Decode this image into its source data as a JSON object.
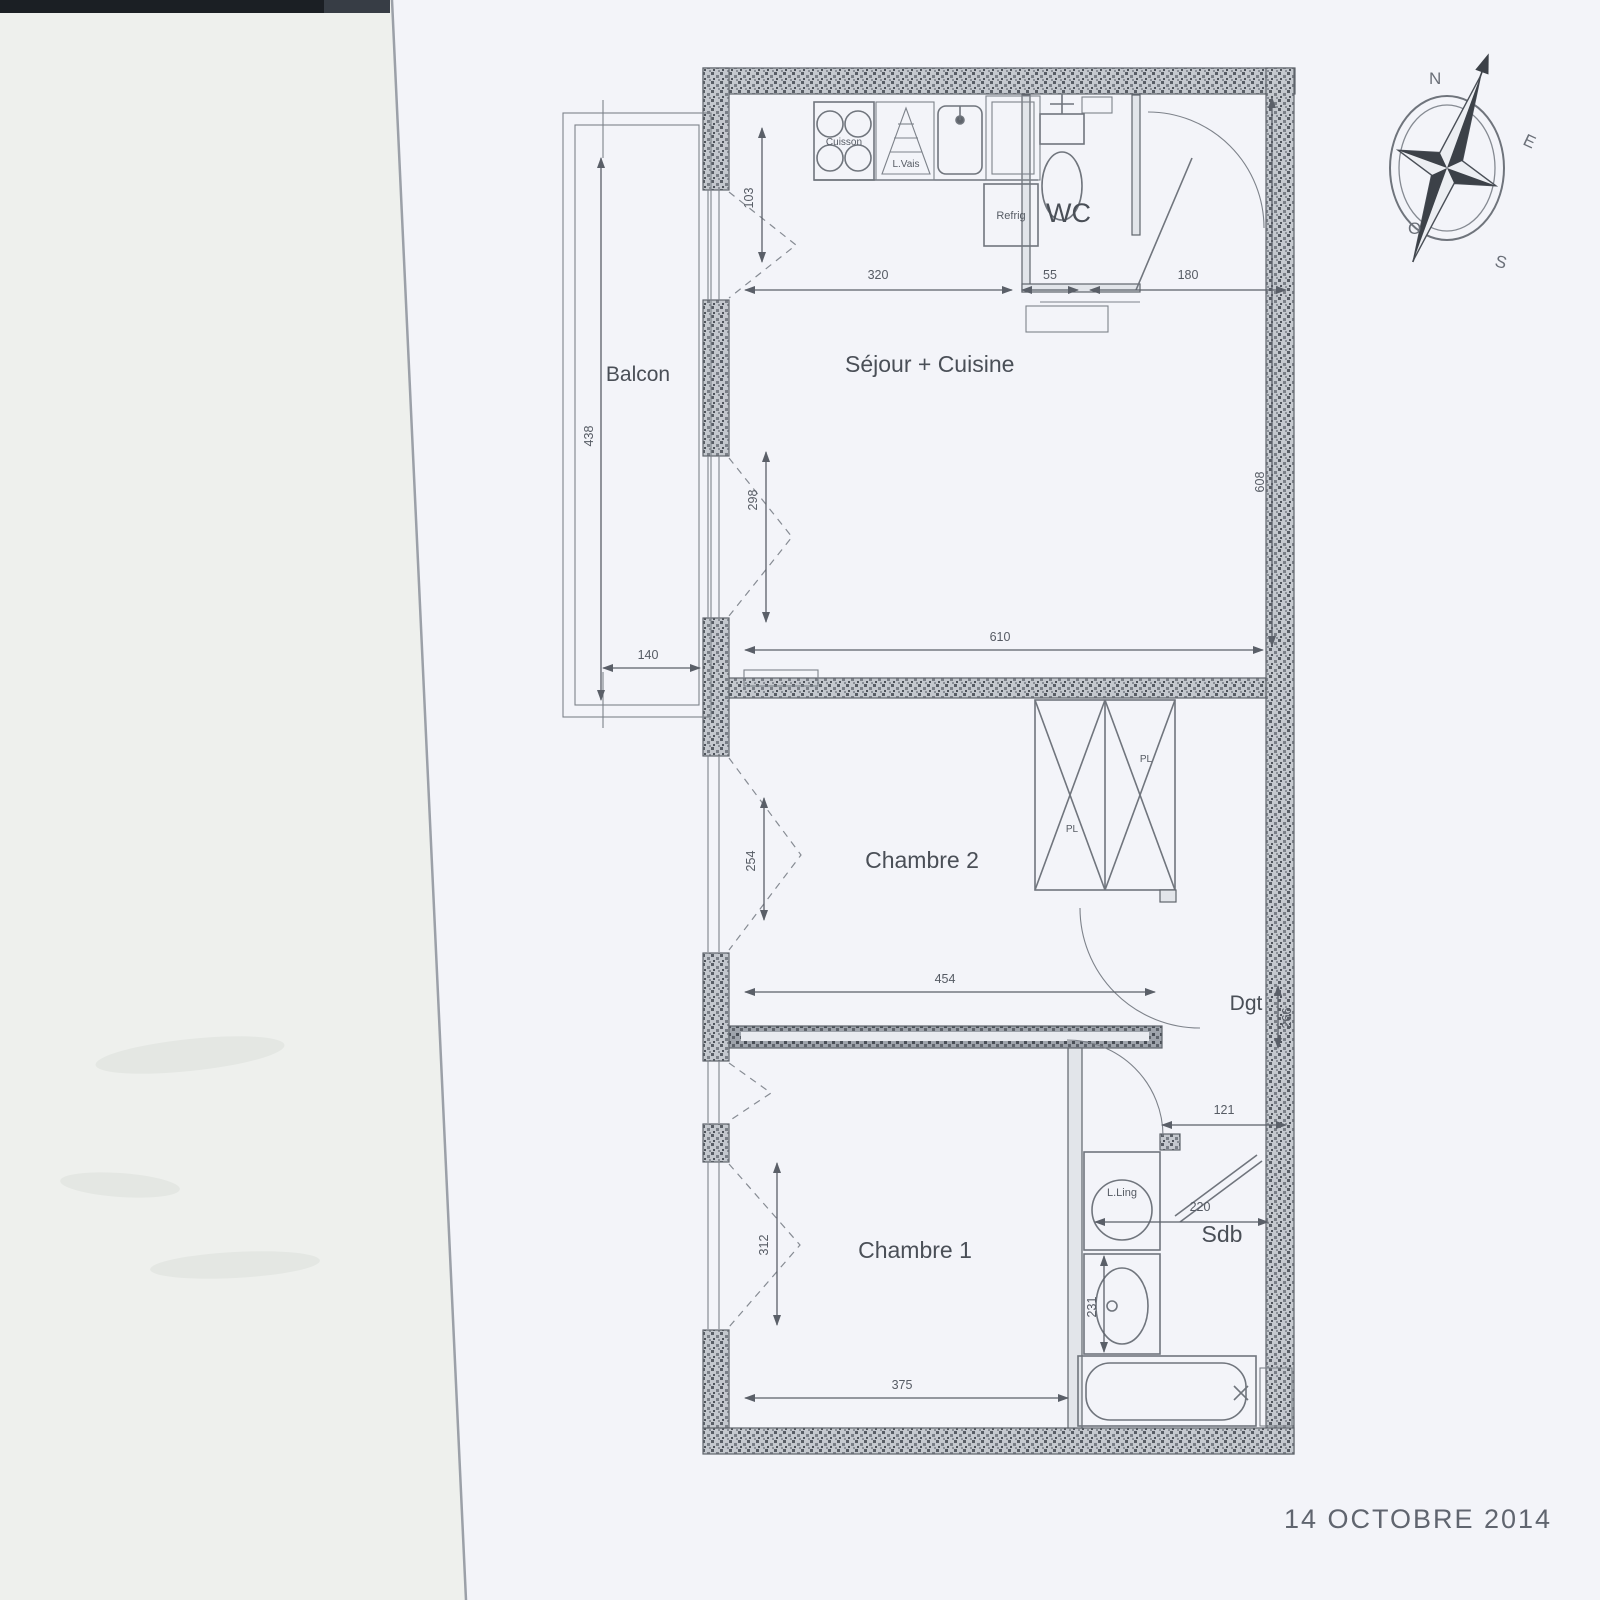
{
  "page": {
    "date_stamp": "14 OCTOBRE 2014"
  },
  "compass": {
    "n": "N",
    "e": "E",
    "s": "S",
    "o": "O"
  },
  "rooms": {
    "balcony": "Balcon",
    "living_kitchen": "Séjour + Cuisine",
    "wc": "WC",
    "bedroom2": "Chambre 2",
    "bedroom1": "Chambre 1",
    "bathroom": "Sdb",
    "hallway": "Dgt"
  },
  "fixtures": {
    "hob": "Cuisson",
    "dishwasher": "L.Vais",
    "fridge": "Refrig",
    "washer": "L.Ling",
    "closet_left": "PL",
    "closet_right": "PL"
  },
  "dimensions": {
    "kitchen_w": "320",
    "wc_w": "55",
    "entry_w": "180",
    "sejour_door": "103",
    "sejour_window": "298",
    "balcony_l": "438",
    "balcony_w": "140",
    "sejour_w": "610",
    "sejour_h": "608",
    "bed2_window": "254",
    "bed2_w": "454",
    "dgt_h": "266",
    "sdb_door": "121",
    "sdb_w": "220",
    "sdb_h": "231",
    "bed1_window": "312",
    "bed1_w": "375"
  }
}
